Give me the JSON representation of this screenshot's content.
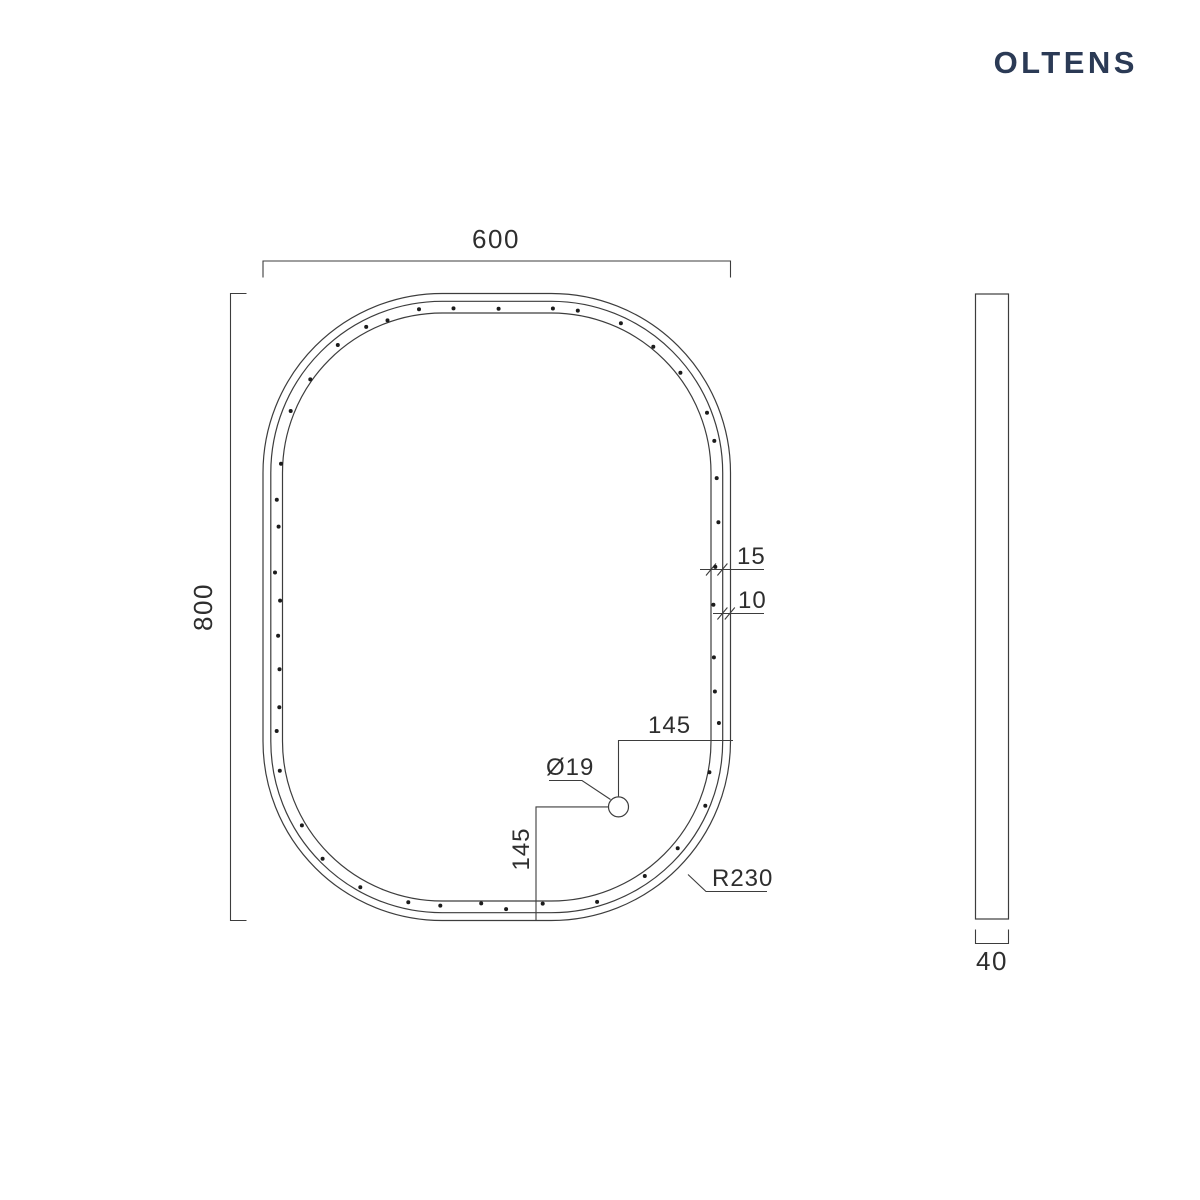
{
  "brand": {
    "logo": "OLTENS",
    "color": "#2b3a55"
  },
  "drawing": {
    "line_color": "#3d3d3d",
    "text_color": "#2e2e2e",
    "dot_color": "#1c1c1c",
    "front_view": {
      "width_label": "600",
      "height_label": "800",
      "corner_radius_label": "R230",
      "frame_band_label": "15",
      "edge_band_label": "10",
      "hole_diameter_label": "Ø19",
      "hole_offset_right_label": "145",
      "hole_offset_bottom_label": "145"
    },
    "side_view": {
      "depth_label": "40"
    },
    "led_dots": {
      "count": 52,
      "seed": 11,
      "min_gap": 22,
      "max_gap": 60,
      "jitter": 3.5,
      "radius": 2
    }
  }
}
